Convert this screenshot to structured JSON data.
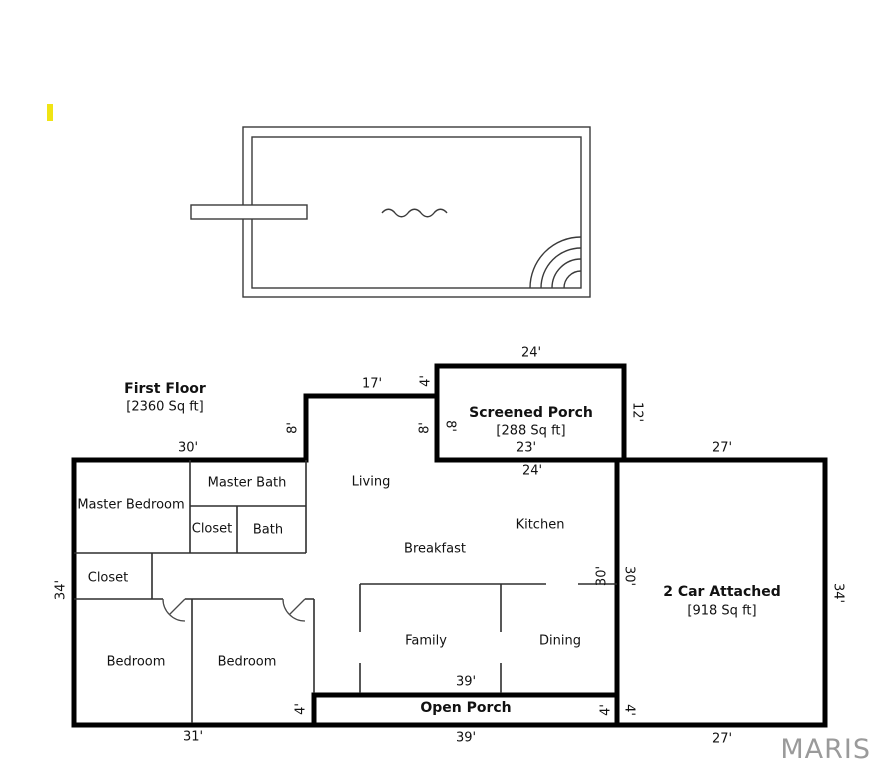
{
  "page": {
    "watermark": "MARIS"
  },
  "colors": {
    "wall_black": "#000000",
    "thin_line": "#2f2f2f",
    "pool_line": "#3a3a3a",
    "highlight_yellow": "#f0e414",
    "watermark_gray": "#9a9a9a"
  },
  "floorplan": {
    "first_floor": {
      "title": "First Floor",
      "area": "[2360 Sq ft]"
    },
    "screened_porch": {
      "title": "Screened Porch",
      "area": "[288 Sq ft]"
    },
    "garage": {
      "title": "2 Car Attached",
      "area": "[918 Sq ft]"
    },
    "open_porch": {
      "title": "Open Porch"
    },
    "rooms": {
      "master_bedroom": "Master Bedroom",
      "master_bath": "Master Bath",
      "master_closet": "Closet",
      "bath": "Bath",
      "living": "Living",
      "kitchen": "Kitchen",
      "breakfast": "Breakfast",
      "hall_closet": "Closet",
      "bedroom_left": "Bedroom",
      "bedroom_middle": "Bedroom",
      "family": "Family",
      "dining": "Dining"
    },
    "dimensions": {
      "master_top": "30'",
      "living_top": "17'",
      "porch_step_left": "4'",
      "porch_top": "24'",
      "porch_right": "12'",
      "living_wall_left": "8'",
      "porch_wall_living_side": "8'",
      "porch_wall_porch_side": "8'",
      "porch_inner_width": "23'",
      "garage_top": "27'",
      "kitchen_top": "24'",
      "house_left": "34'",
      "garage_wall_house_side": "30'",
      "garage_wall_garage_side": "30'",
      "garage_right": "34'",
      "family_width": "39'",
      "open_porch_left": "4'",
      "open_porch_right": "4'",
      "garage_bottom_left": "4'",
      "house_bottom_left": "31'",
      "open_porch_bottom": "39'",
      "garage_bottom": "27'"
    }
  }
}
